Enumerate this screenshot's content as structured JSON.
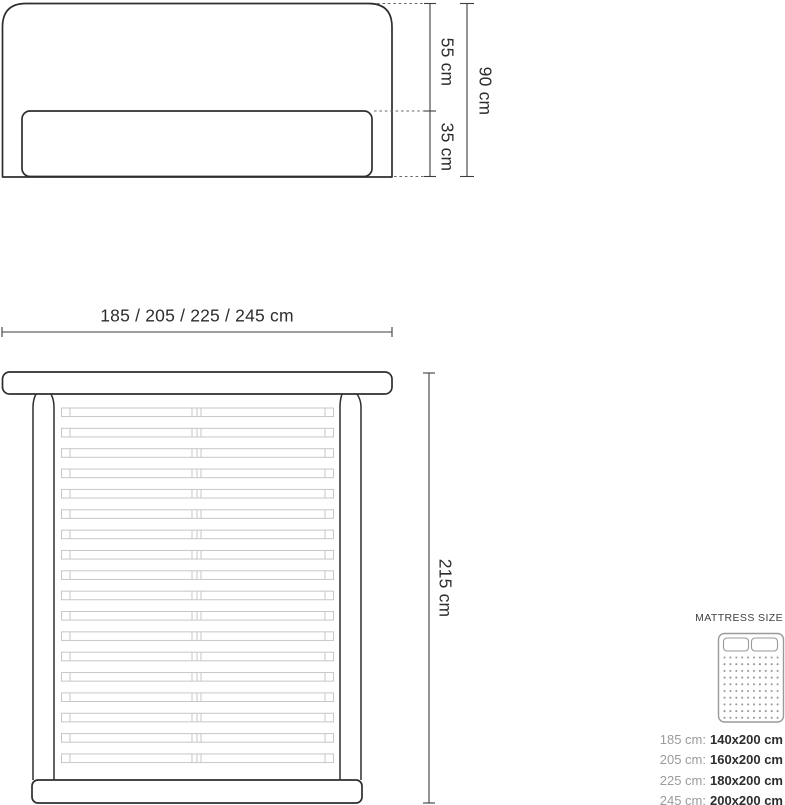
{
  "front_view": {
    "upper_height": "55 cm",
    "lower_height": "35 cm",
    "total_height": "90 cm"
  },
  "top_view": {
    "width_options": "185 / 205 / 225 / 245 cm",
    "length": "215 cm",
    "slat_count": 18
  },
  "legend": {
    "title": "MATTRESS SIZE",
    "icon": "double-mattress-icon",
    "rows": [
      {
        "frame": "185 cm:",
        "mattress": "140x200 cm"
      },
      {
        "frame": "205 cm:",
        "mattress": "160x200 cm"
      },
      {
        "frame": "225 cm:",
        "mattress": "180x200 cm"
      },
      {
        "frame": "245 cm:",
        "mattress": "200x200 cm"
      }
    ]
  },
  "colors": {
    "outline": "#2e2e2e",
    "dimension_line": "#3d3d3d",
    "dashed_line": "#6a6a6a",
    "slat_outline": "#c7c7c7",
    "legend_label_gray": "#9b9b9b",
    "legend_value_dark": "#2d2d2d",
    "icon_gray": "#9a9a9a",
    "background": "#ffffff"
  }
}
